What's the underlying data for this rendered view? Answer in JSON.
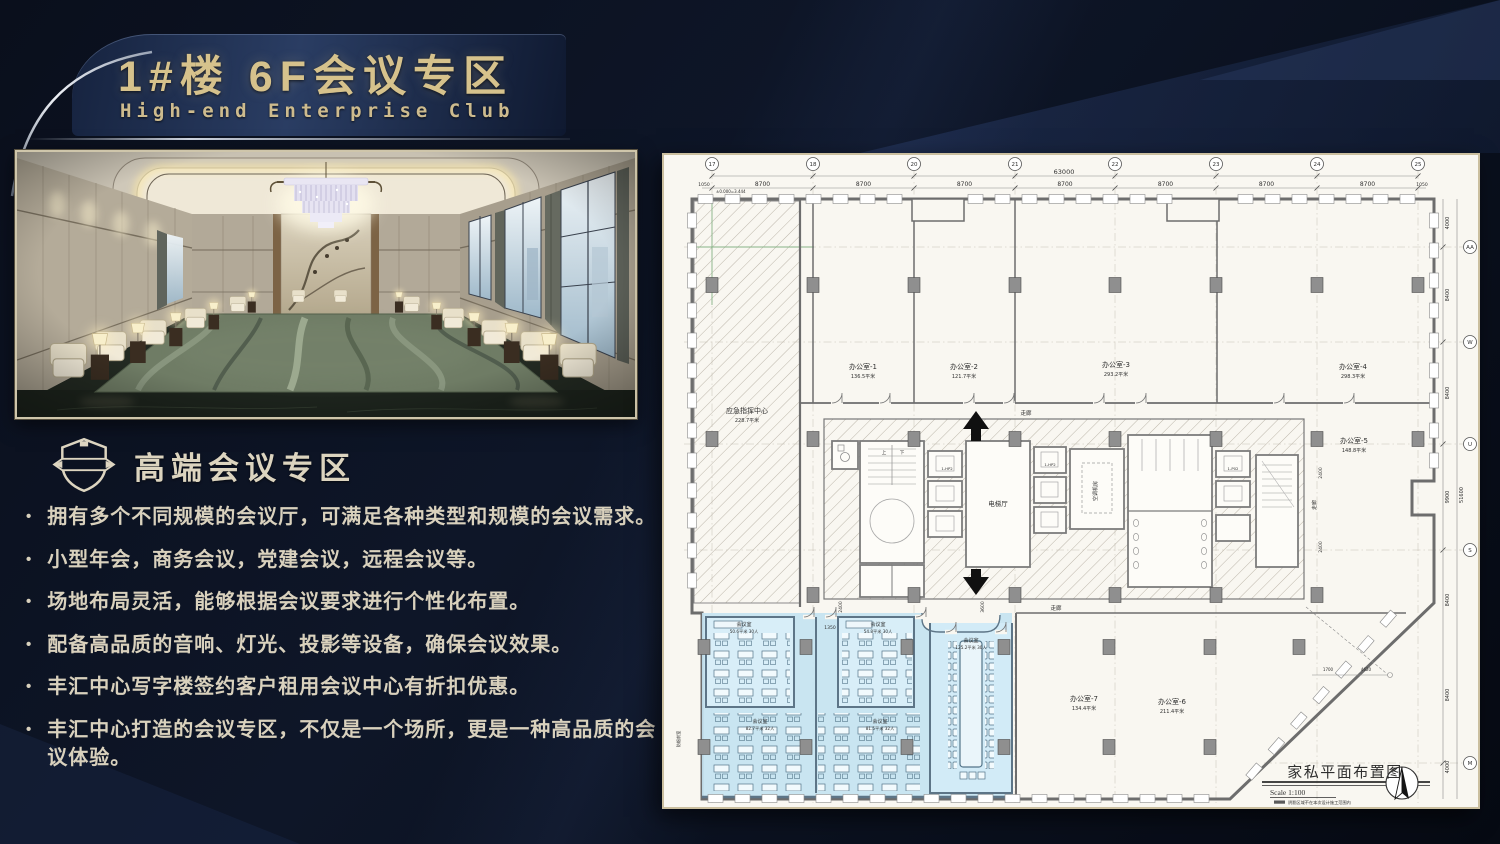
{
  "slide": {
    "title_cn": "1#楼 6F会议专区",
    "title_en": "High-end Enterprise Club",
    "section_title": "高端会议专区",
    "bullet_marker": "•",
    "bullets": [
      "拥有多个不同规模的会议厅，可满足各种类型和规模的会议需求。",
      "小型年会，商务会议，党建会议，远程会议等。",
      "场地布局灵活，能够根据会议要求进行个性化布置。",
      "配备高品质的音响、灯光、投影等设备，确保会议效果。",
      "丰汇中心写字楼签约客户租用会议中心有折扣优惠。",
      "丰汇中心打造的会议专区，不仅是一个场所，更是一种高品质的会议体验。"
    ]
  },
  "plan": {
    "title_block": {
      "title": "家私平面布置图",
      "scale": "Scale 1:100",
      "note": "阴影区域不在本次设计施工范围内"
    },
    "top_grid": [
      {
        "n": "17",
        "x": 48
      },
      {
        "n": "18",
        "x": 149
      },
      {
        "n": "20",
        "x": 250
      },
      {
        "n": "21",
        "x": 351
      },
      {
        "n": "22",
        "x": 451
      },
      {
        "n": "23",
        "x": 552
      },
      {
        "n": "24",
        "x": 653
      },
      {
        "n": "25",
        "x": 754
      }
    ],
    "right_grid": [
      {
        "n": "AA",
        "y": 92
      },
      {
        "n": "W",
        "y": 187
      },
      {
        "n": "U",
        "y": 289
      },
      {
        "n": "S",
        "y": 395
      },
      {
        "n": "M",
        "y": 608
      }
    ],
    "dims": {
      "total_width": "63000",
      "bay_width": "8700",
      "edge": "1050",
      "right_dims": [
        "4000",
        "8400",
        "8400",
        "9900",
        "8400",
        "8400",
        "4000"
      ],
      "total_height": "51600"
    },
    "rooms": [
      {
        "name": "办公室-1",
        "area": "136.5平米",
        "x": 199,
        "y": 214
      },
      {
        "name": "办公室-2",
        "area": "121.7平米",
        "x": 300,
        "y": 214
      },
      {
        "name": "办公室-3",
        "area": "293.2平米",
        "x": 452,
        "y": 212
      },
      {
        "name": "办公室-4",
        "area": "298.3平米",
        "x": 689,
        "y": 214
      },
      {
        "name": "办公室-5",
        "area": "148.8平米",
        "x": 690,
        "y": 288
      },
      {
        "name": "办公室-7",
        "area": "134.4平米",
        "x": 420,
        "y": 546
      },
      {
        "name": "办公室-6",
        "area": "211.4平米",
        "x": 508,
        "y": 549
      },
      {
        "name": "应急指挥中心",
        "area": "228.7平米",
        "x": 83,
        "y": 258
      }
    ],
    "meeting_rooms": [
      {
        "name": "会议室",
        "area": "50.6平米",
        "capacity": "30人",
        "x": 80,
        "y": 471
      },
      {
        "name": "会议室",
        "area": "54.8平米",
        "capacity": "30人",
        "x": 214,
        "y": 471
      },
      {
        "name": "会议室",
        "area": "125.2平米",
        "capacity": "30人",
        "x": 307,
        "y": 487
      },
      {
        "name": "会议室",
        "area": "82.7平米",
        "capacity": "32人",
        "x": 96,
        "y": 568
      },
      {
        "name": "会议室",
        "area": "81.5平米",
        "capacity": "32人",
        "x": 216,
        "y": 568
      }
    ],
    "annotations": [
      {
        "t": "±0.000=3.444",
        "x": 52,
        "y": 38,
        "s": 4,
        "a": "start"
      },
      {
        "t": "电梯厅",
        "x": 334,
        "y": 351,
        "s": 6.5
      },
      {
        "t": "空调机房",
        "x": 433,
        "y": 336,
        "s": 5,
        "r": -90
      },
      {
        "t": "走廊",
        "x": 362,
        "y": 260,
        "s": 5.5
      },
      {
        "t": "走廊",
        "x": 392,
        "y": 455,
        "s": 5.5
      },
      {
        "t": "走廊",
        "x": 652,
        "y": 350,
        "s": 5,
        "r": -90
      },
      {
        "t": "2400",
        "x": 658,
        "y": 318,
        "s": 4.5,
        "r": -90
      },
      {
        "t": "2400",
        "x": 658,
        "y": 392,
        "s": 4.5,
        "r": -90
      },
      {
        "t": "2400",
        "x": 178,
        "y": 452,
        "s": 4.5,
        "r": -90
      },
      {
        "t": "3600",
        "x": 320,
        "y": 452,
        "s": 4.5,
        "r": -90
      },
      {
        "t": "1350",
        "x": 166,
        "y": 474,
        "s": 4.5
      },
      {
        "t": "防烟前室",
        "x": 16,
        "y": 584,
        "s": 4.2,
        "r": -90
      },
      {
        "t": "1-HP2",
        "x": 283,
        "y": 315,
        "s": 3.8
      },
      {
        "t": "1-HP2",
        "x": 386,
        "y": 311,
        "s": 3.8
      },
      {
        "t": "1-P02",
        "x": 569,
        "y": 315,
        "s": 3.8
      },
      {
        "t": "1700",
        "x": 664,
        "y": 516,
        "s": 4
      },
      {
        "t": "4620",
        "x": 702,
        "y": 516,
        "s": 4
      },
      {
        "t": "上",
        "x": 220,
        "y": 299,
        "s": 4.5
      },
      {
        "t": "下",
        "x": 238,
        "y": 299,
        "s": 4.5
      }
    ]
  },
  "colors": {
    "gold": "#d6c28c",
    "cream": "#d9d1bd",
    "background": "#0a0f1c",
    "plan_paper": "#f9f7f1",
    "plan_highlight_blue": "#c3e2f1",
    "plan_wall_gray": "#6d6d6d"
  }
}
